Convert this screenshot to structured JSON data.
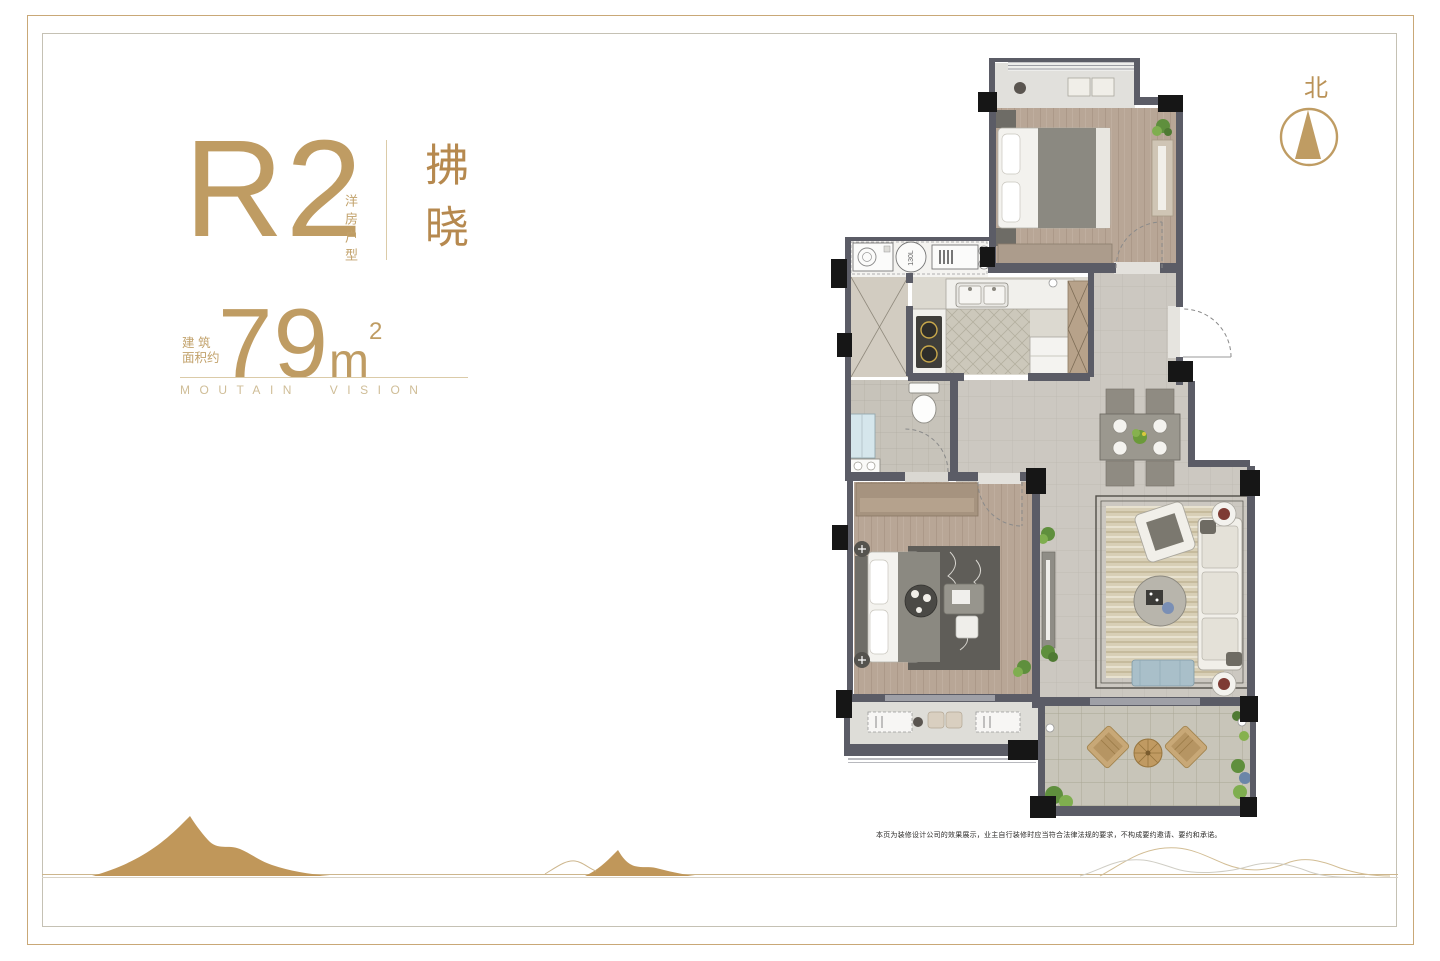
{
  "unit": {
    "code": "R2",
    "type_vertical": "洋房户型",
    "name": "拂晓",
    "area_prefix": "建 筑\n面积约",
    "area_value": "79",
    "area_unit": "m",
    "area_sup": "2",
    "slogan": "MOUTAIN VISION"
  },
  "compass": {
    "label": "北"
  },
  "plan": {
    "tank_label": "130L"
  },
  "footer": {
    "disclaimer": "本页为装修设计公司的效果展示，业主自行装修时应当符合法律法规的要求，不构成要约邀请、要约和承诺。"
  },
  "colors": {
    "accent_gold": "#bf9c63",
    "deep_gold": "#b6894f",
    "wall_gray": "#5b5c66",
    "column_black": "#161616",
    "mountain_gold": "#c0975a"
  }
}
